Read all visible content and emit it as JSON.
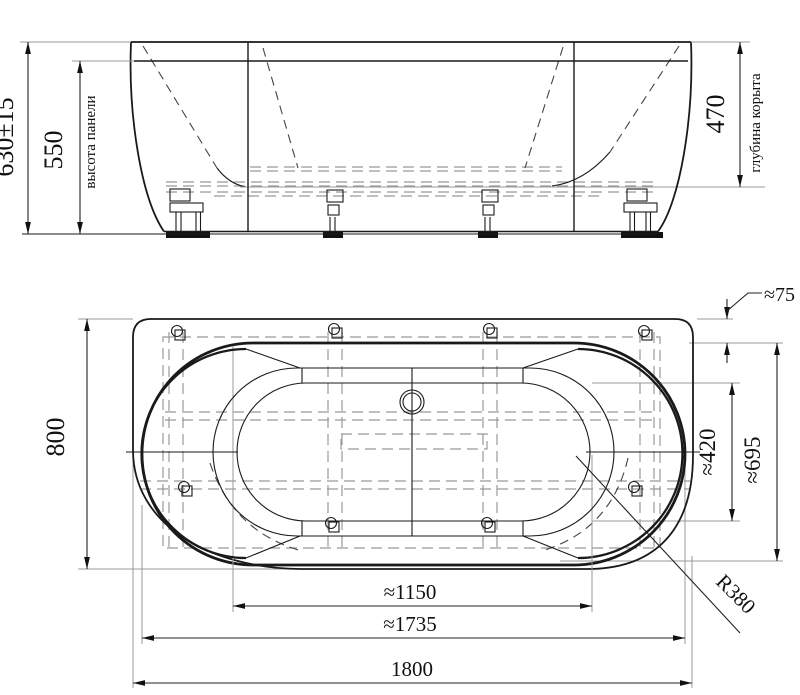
{
  "colors": {
    "line": "#1a1a1a",
    "dim": "#222222",
    "extension": "#999999",
    "background": "#ffffff"
  },
  "front_view": {
    "overall_height": "630±15",
    "panel_height": "550",
    "panel_height_caption": "высота панели",
    "bowl_depth": "470",
    "bowl_depth_caption": "глубина корыта"
  },
  "plan_view": {
    "overall_width": "800",
    "rim_offset": "≈75",
    "bowl_inner_width": "≈420",
    "rim_width": "≈695",
    "bowl_inner_length": "≈1150",
    "rim_length": "≈1735",
    "overall_length": "1800",
    "corner_radius": "R380"
  }
}
